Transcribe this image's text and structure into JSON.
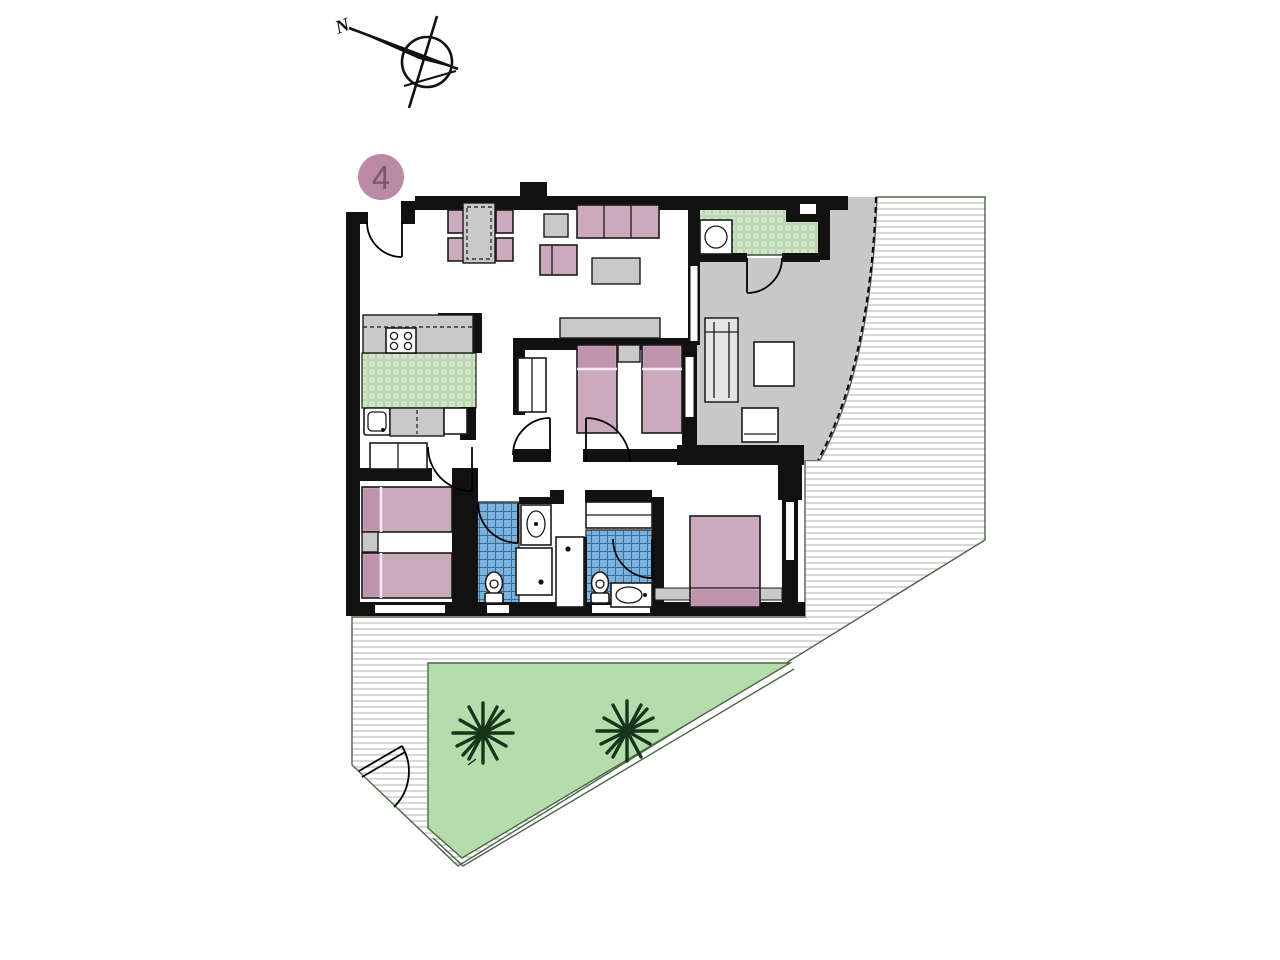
{
  "title": "Apartment floor plan, unit 4, with terrace and private garden",
  "compass": {
    "label": "N"
  },
  "unit_badge": {
    "number": "4"
  },
  "colors": {
    "wall": "#111111",
    "outline": "#1a1a1a",
    "furniture_pink": "#cbaabc",
    "furniture_pink_dark": "#c194ad",
    "badge_pink": "#bb8ba4",
    "badge_text": "#7a576c",
    "gray_terrace": "#c8c8c8",
    "gray_furniture": "#c9c9c9",
    "tile_green": "#cfe6c6",
    "tile_green_line": "#8fbc85",
    "tile_blue": "#79b2dd",
    "tile_blue_line": "#3c6c99",
    "garden_green": "#b7dcab",
    "boundary_green": "#4b6647",
    "palm_green": "#16351c",
    "deck_line": "#b3b3b3"
  },
  "symbols": [
    "north-compass",
    "unit-number-badge",
    "entrance-door",
    "dining-table",
    "dining-chair",
    "sofa",
    "armchair",
    "coffee-table",
    "side-table",
    "tv-unit",
    "kitchen-hob",
    "kitchen-sink",
    "washing-machine",
    "sun-lounger",
    "terrace-table",
    "terrace-chair",
    "single-bed",
    "double-bed",
    "nightstand",
    "wardrobe",
    "toilet",
    "washbasin",
    "shower",
    "bathtub",
    "palm-tree",
    "garden-gate"
  ]
}
